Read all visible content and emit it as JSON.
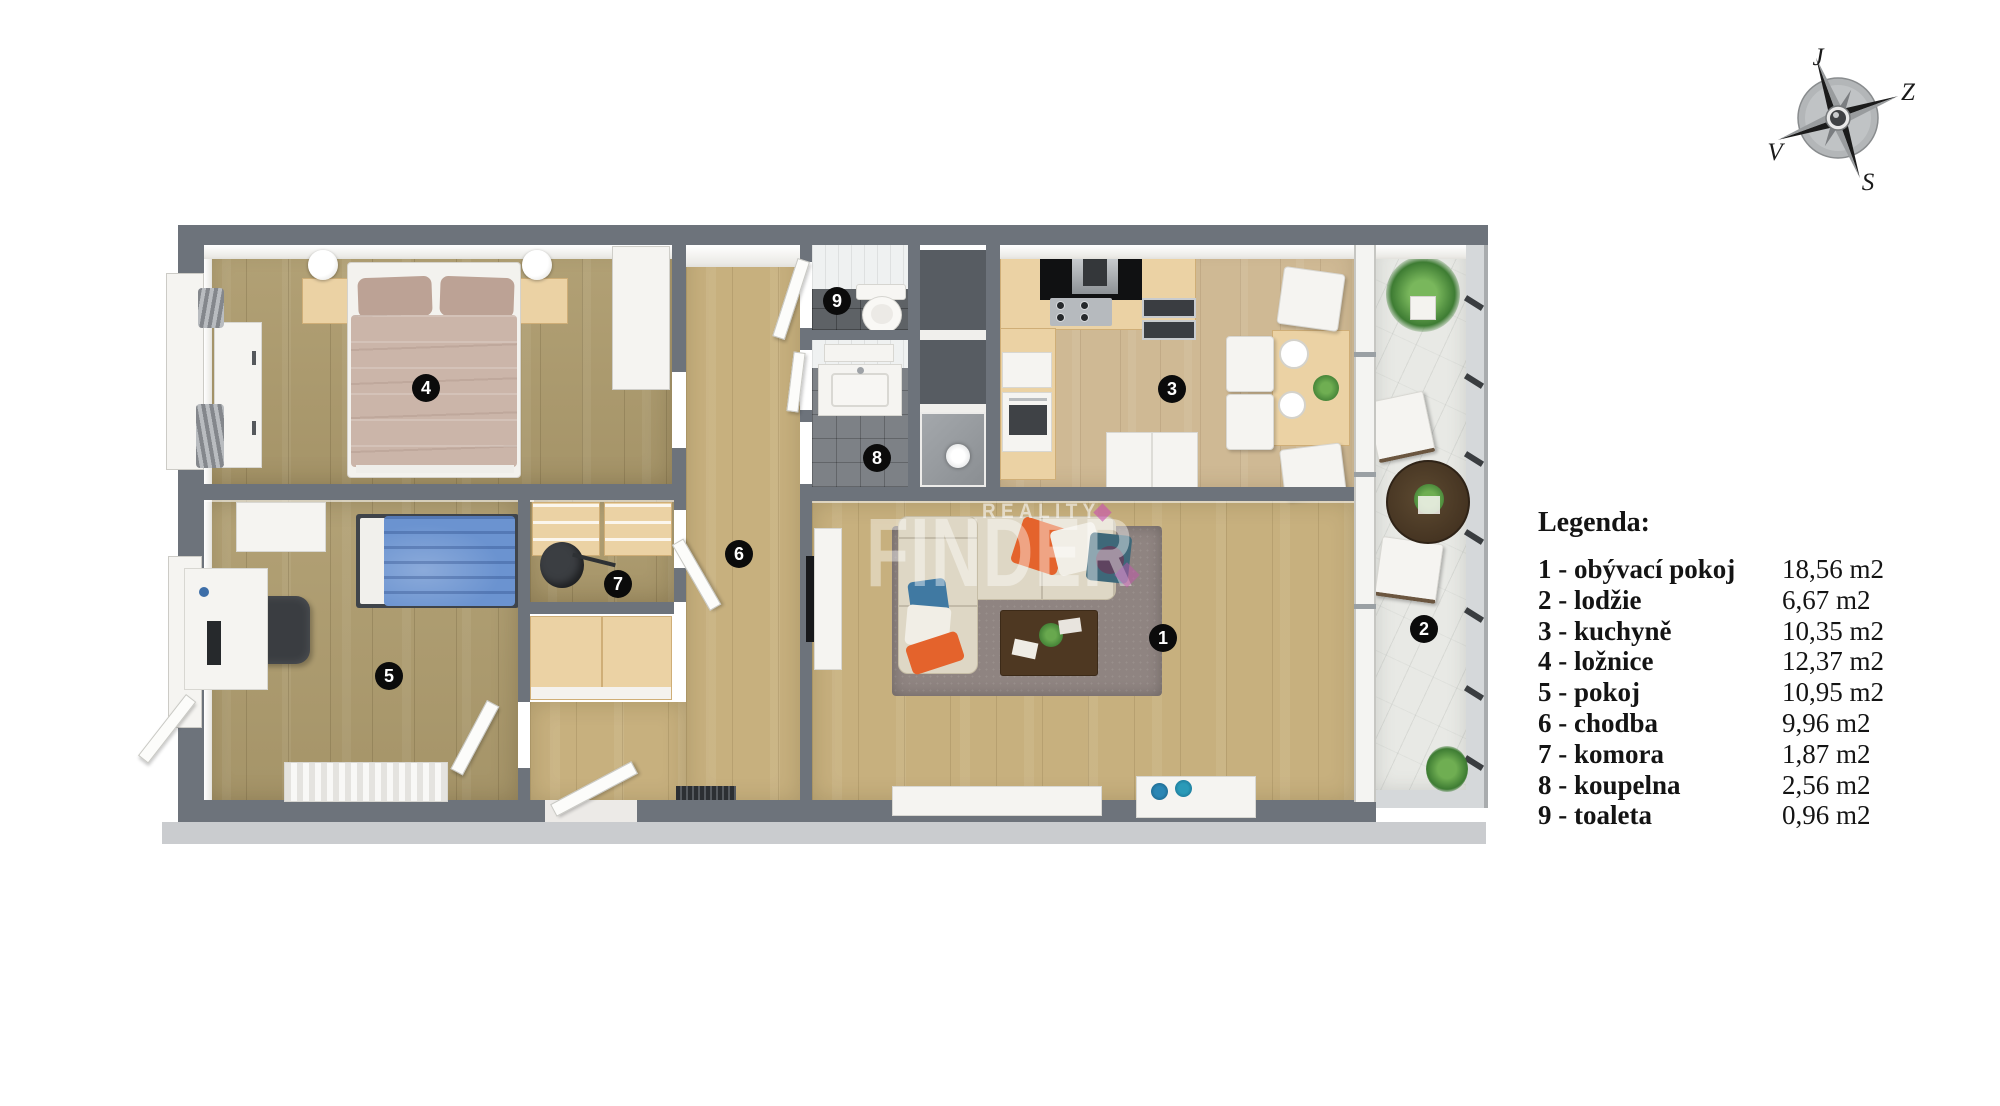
{
  "legend": {
    "title": "Legenda:",
    "items": [
      {
        "number": "1",
        "label": "1 - obývací pokoj",
        "area": "18,56 m2"
      },
      {
        "number": "2",
        "label": "2 - lodžie",
        "area": "6,67 m2"
      },
      {
        "number": "3",
        "label": "3 - kuchyně",
        "area": "10,35 m2"
      },
      {
        "number": "4",
        "label": "4 - ložnice",
        "area": "12,37 m2"
      },
      {
        "number": "5",
        "label": "5 - pokoj",
        "area": "10,95 m2"
      },
      {
        "number": "6",
        "label": "6 - chodba",
        "area": "9,96 m2"
      },
      {
        "number": "7",
        "label": "7 - komora",
        "area": "1,87 m2"
      },
      {
        "number": "8",
        "label": "8 - koupelna",
        "area": "2,56 m2"
      },
      {
        "number": "9",
        "label": "9 - toaleta",
        "area": "0,96 m2"
      }
    ]
  },
  "compass": {
    "top": "J",
    "right": "Z",
    "bottom": "S",
    "left": "V"
  },
  "watermark": {
    "brand": "FINDER",
    "tagline": "REALITY"
  },
  "colors": {
    "wall": "#6d737b",
    "wood_bedroom": "#ae9c6e",
    "wood_living": "#c7b07e",
    "wood_kitchen": "#cfb994",
    "counter": "#ebd2a4",
    "marble": "#e8e9e5",
    "accent_magenta": "#c94fb0",
    "badge": "#0b0b0b",
    "sofa": "#ded7c5",
    "pillow_orange": "#e4632c",
    "pillow_teal": "#3e6879",
    "bed_blue": "#6b93d0",
    "bed_beige": "#cbb5a9"
  }
}
